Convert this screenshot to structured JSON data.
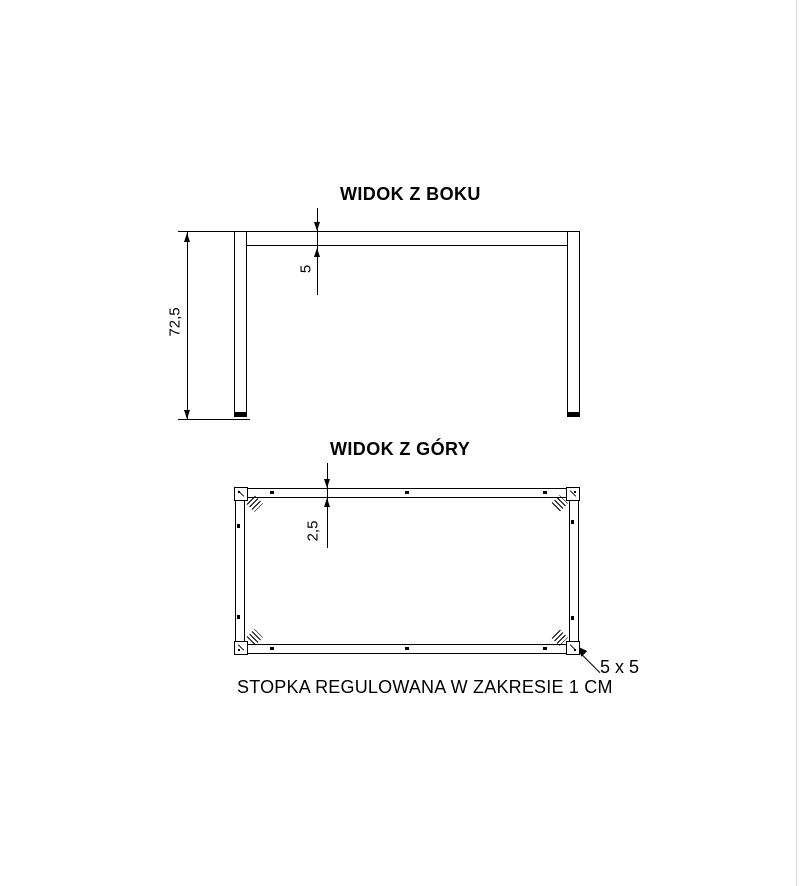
{
  "side_view": {
    "title": "WIDOK Z BOKU",
    "height_dim": "72,5",
    "beam_thickness_dim": "5"
  },
  "top_view": {
    "title": "WIDOK Z GÓRY",
    "rail_width_dim": "2,5",
    "leg_section_label": "5 x 5"
  },
  "caption": "STOPKA REGULOWANA W ZAKRESIE 1 CM",
  "colors": {
    "line": "#000000",
    "background": "#ffffff"
  }
}
